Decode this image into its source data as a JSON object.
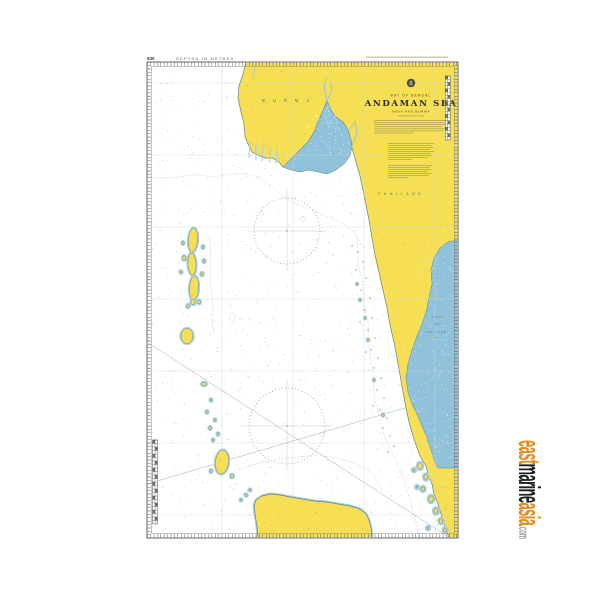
{
  "header": {
    "chart_number": "830",
    "depths_note": "DEPTHS IN METRES"
  },
  "title_block": {
    "sea_area": "BAY OF BENGAL",
    "title": "ANDAMAN SEA",
    "subtitle": "INDIA AND BURMA"
  },
  "labels": {
    "burma": "BURMA",
    "thailand": "THAILAND",
    "gulf_of_thailand": [
      "GULF",
      "OF",
      "THAILAND"
    ]
  },
  "watermark": {
    "east": "east",
    "marine": "marine",
    "asia": "asia",
    "domain_suffix": ".com"
  },
  "colors": {
    "paper": "#ffffff",
    "land": "#f6df55",
    "shallow": "#a9d0e2",
    "gulf_blue": "#90c2db",
    "coastline": "#5e8494",
    "graticule": "#ccd3d8",
    "ink": "#3c3c30",
    "watermark_orange": "#e8891c",
    "watermark_black": "#1f1f1f",
    "watermark_gray": "#9c9c9c"
  }
}
